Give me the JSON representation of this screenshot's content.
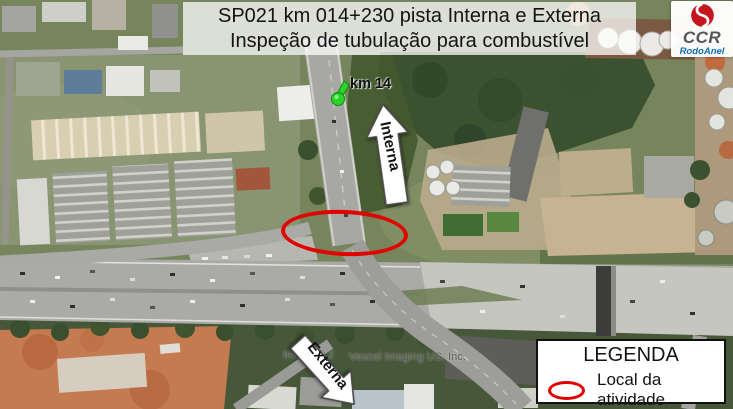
{
  "title": {
    "line1": "SP021 km 014+230 pista Interna e Externa",
    "line2": "Inspeção de tubulação para combustível"
  },
  "logo": {
    "company": "CCR",
    "division": "RodoAnel"
  },
  "map": {
    "marker": {
      "label": "km 14"
    },
    "arrows": [
      {
        "label": "Interna",
        "direction": "up"
      },
      {
        "label": "Externa",
        "direction": "down-right"
      }
    ],
    "highlight": {
      "shape": "ellipse",
      "meaning": "Local da atividade",
      "color": "#e00300"
    },
    "watermark": {
      "prefix": "Image © 2",
      "suffix": "Vexcel Imaging US, Inc."
    }
  },
  "legend": {
    "title": "LEGENDA",
    "items": [
      {
        "symbol": "red-ellipse",
        "label": "Local da atividade"
      }
    ]
  },
  "colors": {
    "highlight_red": "#e00300",
    "logo_red": "#c5161d",
    "logo_gray": "#54555a",
    "logo_blue": "#0c6cb4",
    "pin_green": "#2bd42b"
  }
}
